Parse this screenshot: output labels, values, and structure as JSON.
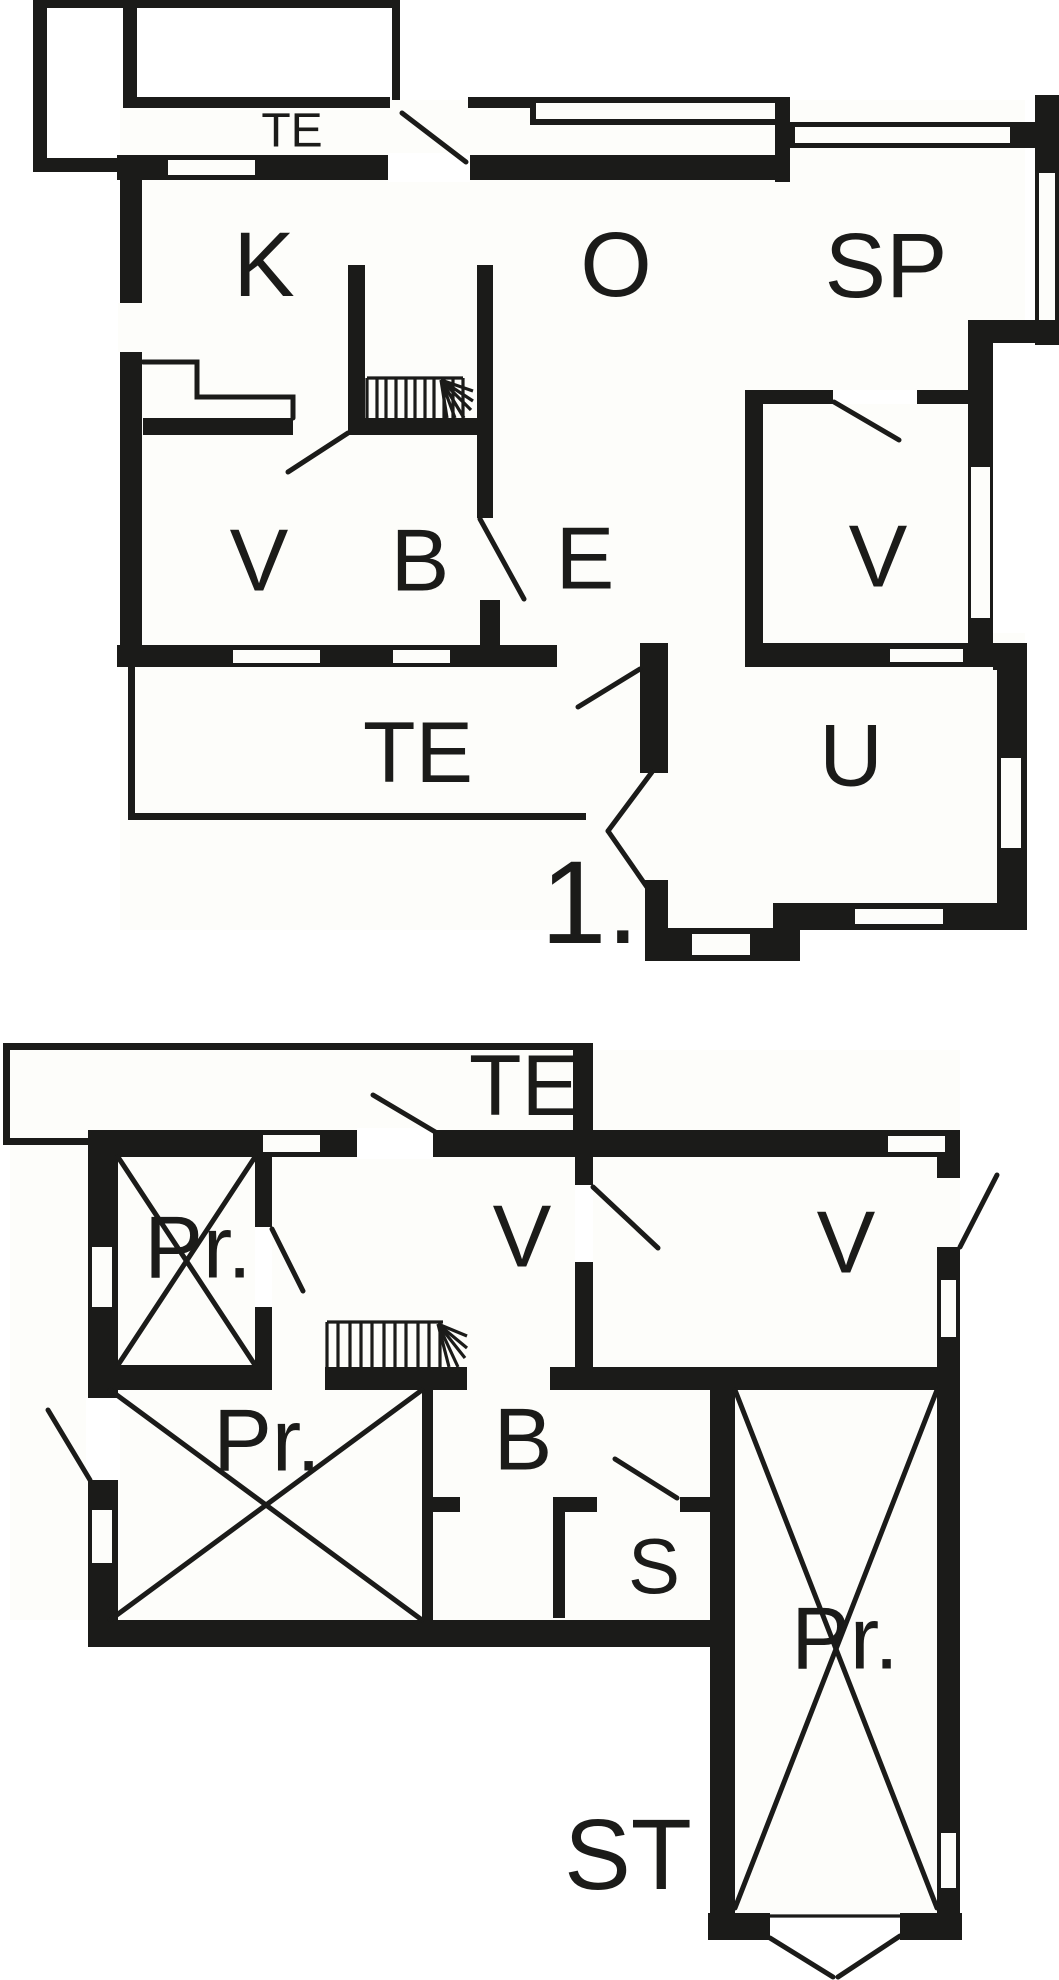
{
  "drawing": {
    "type": "floor-plan",
    "colors": {
      "wall": "#1b1b19",
      "background": "#ffffff",
      "paper": "#fbfbf5"
    }
  },
  "floor1": {
    "floor_label": "1.",
    "rooms": {
      "terrace_top": "TE",
      "kitchen_k": "K",
      "living_o": "O",
      "bedroom_sp": "SP",
      "room_v_west": "V",
      "bath_b": "B",
      "entry_e": "E",
      "room_v_east": "V",
      "terrace_south": "TE",
      "utility_u": "U"
    }
  },
  "ground_floor": {
    "floor_label": "ST",
    "rooms": {
      "terrace": "TE",
      "storage_nw": "Pr.",
      "hall_v": "V",
      "room_v_east": "V",
      "storage_sw": "Pr.",
      "bath_b": "B",
      "sauna_s": "S",
      "storage_tall": "Pr."
    }
  }
}
